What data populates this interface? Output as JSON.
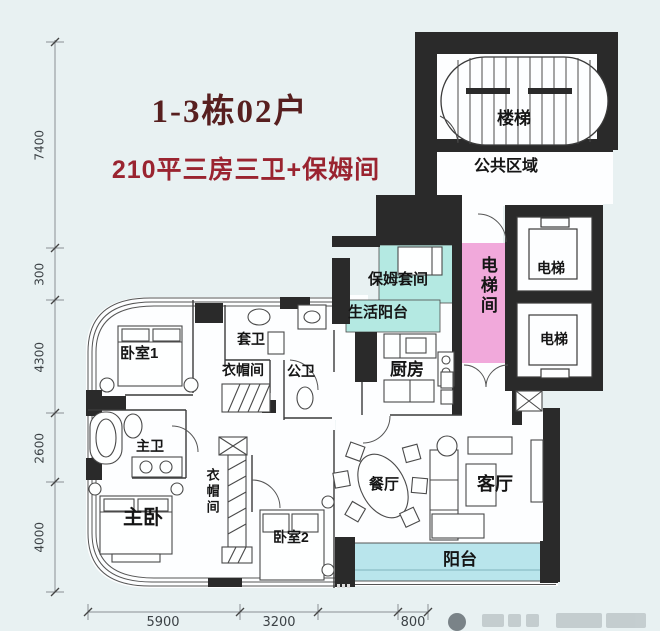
{
  "page": {
    "background": "#e8f1f2"
  },
  "header": {
    "title": "1-3栋02户",
    "subtitle": "210平三房三卫+保姆间"
  },
  "labels": {
    "stairs": "楼梯",
    "public_area": "公共区域",
    "elevator_top": "电梯",
    "elevator_bottom": "电梯",
    "elevator_hall": "电梯间",
    "nanny_suite": "保姆套间",
    "service_balcony": "生活阳台",
    "kitchen": "厨房",
    "bedroom_1": "卧室1",
    "ensuite_bath": "套卫",
    "cloakroom_top": "衣帽间",
    "guest_bath": "公卫",
    "master_bath": "主卫",
    "master_bedroom": "主卧",
    "cloakroom_master": "衣帽间",
    "bedroom_2": "卧室2",
    "dining_room": "餐厅",
    "living_room": "客厅",
    "balcony": "阳台"
  },
  "dimensions": {
    "left": [
      "7400",
      "300",
      "4300",
      "2600",
      "4000"
    ],
    "bottom": [
      "5900",
      "3200",
      "800"
    ]
  },
  "colors": {
    "wall": "#2a2a2a",
    "elevator_hall_fill": "#f1a9db",
    "nanny_fill": "#b4e9e2",
    "balcony_fill": "#b9e5ec",
    "title_text": "#571f1f",
    "subtitle_text": "#9a2430"
  }
}
